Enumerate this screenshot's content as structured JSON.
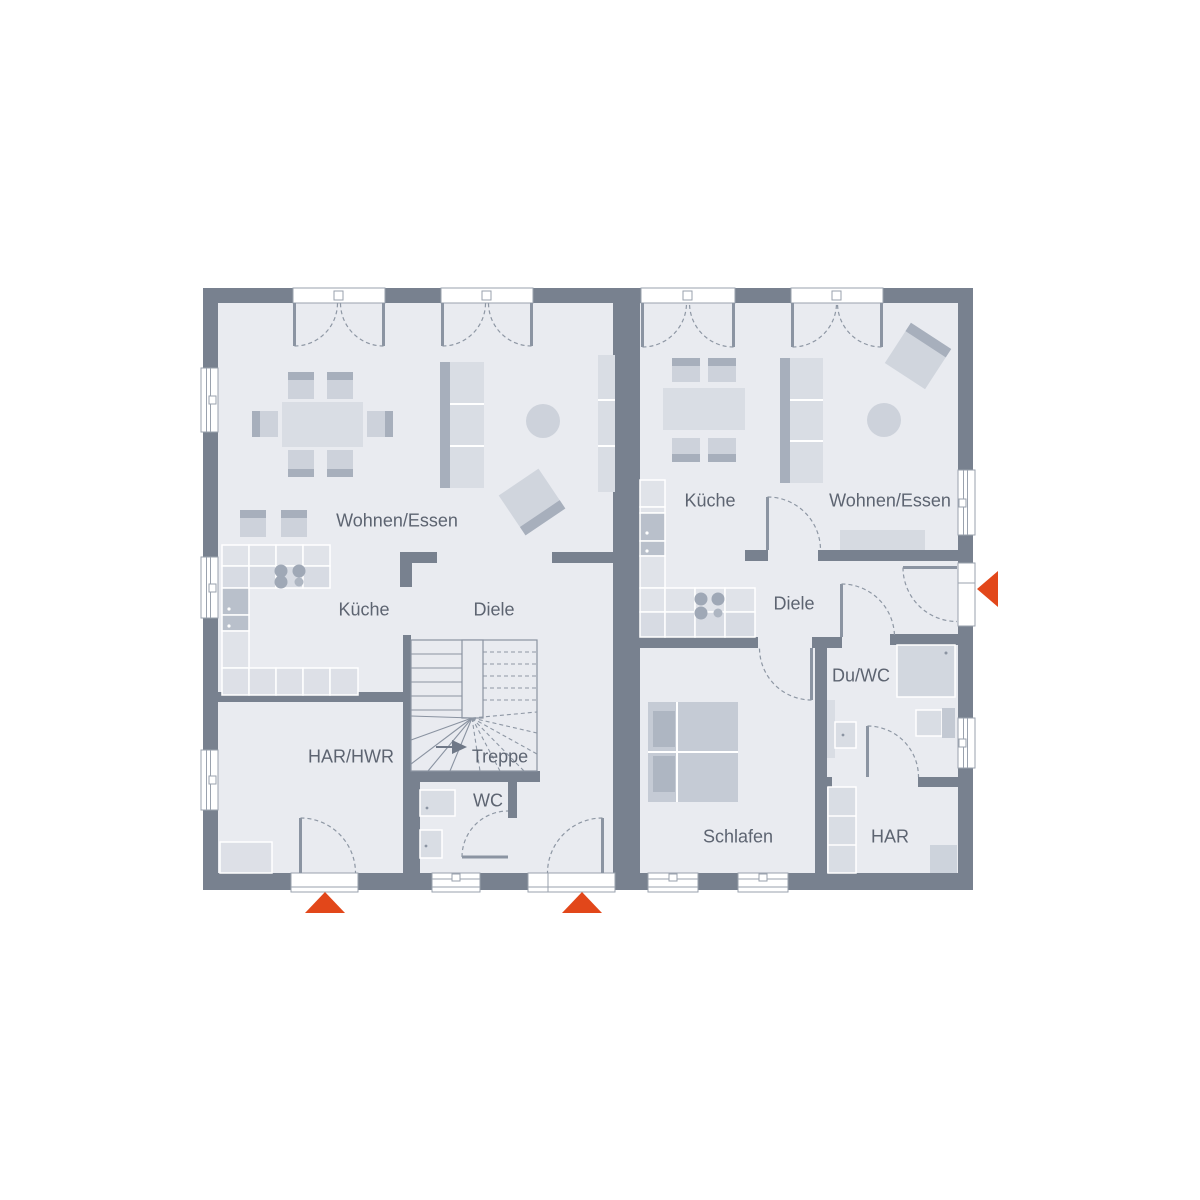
{
  "page": {
    "type": "floor-plan",
    "background": "#ffffff"
  },
  "colors": {
    "wall": "#78818F",
    "floor": "#E9EBF0",
    "furniture_light": "#D9DDE4",
    "furniture_mid": "#CDD2DB",
    "furniture_dark": "#A7AFBC",
    "appliance": "#B9C0CB",
    "line": "#8B94A2",
    "label_text": "#5D6471",
    "entrance_accent": "#E2471A"
  },
  "left_unit": {
    "rooms": {
      "living": "Wohnen/Essen",
      "kitchen": "Küche",
      "hall": "Diele",
      "utility": "HAR/HWR",
      "stairs": "Treppe",
      "wc": "WC"
    }
  },
  "right_unit": {
    "rooms": {
      "kitchen": "Küche",
      "living": "Wohnen/Essen",
      "hall": "Diele",
      "bath": "Du/WC",
      "bedroom": "Schlafen",
      "storage": "HAR"
    }
  },
  "icons": {
    "entrance_arrow": "entrance-arrow"
  }
}
